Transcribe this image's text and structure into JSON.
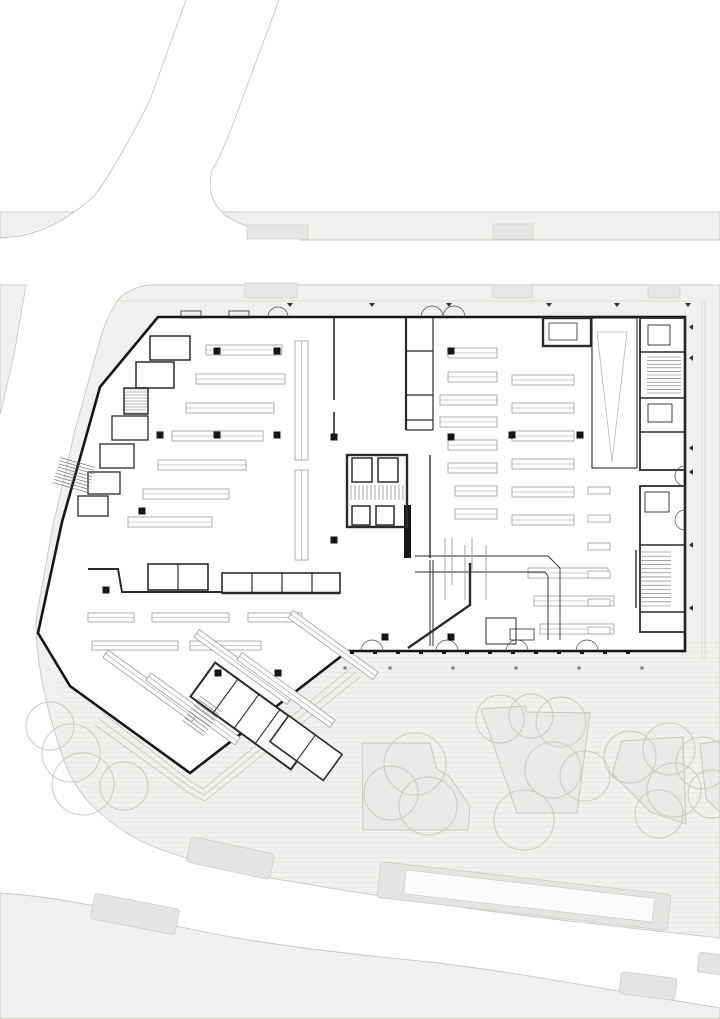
{
  "title": "site-floor-plan",
  "colors": {
    "background": "#ffffff",
    "pavement": "#f1f0ee",
    "pavement_edge": "#c9c6c2",
    "median": "#e6e4e2",
    "median_edge": "#cfccc8",
    "median_inset": "#fbfbfa",
    "canopy": "#e7e6e4",
    "planter": "#eae9e7",
    "planter_edge": "#c9c6c2",
    "tree": "#ccc9c5",
    "hatch": "#e3e1dd",
    "wall": "#161616",
    "wall_medium": "#2b2b2b",
    "shelf": "#9c9c9c",
    "faint": "#b9b6b2",
    "terrace": "#c6c3bf",
    "pipe": "#8f8f8f",
    "tick": "#333333"
  },
  "site": {
    "band_top": [
      0,
      212,
      720,
      28
    ],
    "region_main": "M150,285 L720,285 L720,938 C630,928 520,916 460,907 C420,901 370,895 330,888 C285,880 245,875 220,868 C185,858 155,849 135,838 C100,817 75,795 62,755 C48,713 36,668 36,620 L52,530 L75,430 L100,340 C104,325 110,312 118,300 C126,291 138,286 150,285 Z",
    "corner_bottom_left": "M0,893 C60,897 120,910 160,922 C240,942 330,952 430,962 C530,974 620,992 720,1008 L720,1019 L0,1019 Z",
    "sliver_left": "0,285 26,285 14,355 0,415",
    "road_diag_fill": "M186,0 L279,0 L240,105 Q220,160 212,170 Q205,198 225,215 Q245,230 300,238 L300,241 L0,241 L0,238 Q60,230 95,195 Q125,160 150,100 Z",
    "road_edges": [
      "M186,0 L150,100 Q120,160 95,195 Q60,228 20,236 L0,238",
      "M279,0 L240,105 Q220,160 212,170 Q205,198 225,215 Q245,230 300,238"
    ],
    "hatch_zone": [
      60,
      640,
      660,
      300
    ],
    "medians": [
      [
        188,
        845,
        85,
        26,
        12
      ],
      [
        92,
        901,
        86,
        26,
        11
      ],
      [
        378,
        878,
        292,
        36,
        6.5
      ],
      [
        620,
        975,
        56,
        22,
        7
      ],
      [
        698,
        954,
        34,
        20,
        7
      ]
    ],
    "median_inset": [
      404,
      884,
      250,
      24,
      6.5
    ],
    "canopies": [
      [
        247,
        225,
        61,
        14
      ],
      [
        493,
        224,
        40,
        15
      ],
      [
        245,
        283,
        52,
        15
      ],
      [
        493,
        285,
        39,
        13
      ],
      [
        648,
        285,
        32,
        13
      ]
    ],
    "planters": [
      "362,743 430,743 437,769 449,776 470,806 468,830 363,830",
      "481,709 526,706 526,712 590,713 577,813 517,813",
      "622,741 683,737 686,824 650,812 636,797 612,774",
      "700,744 720,741 720,812 706,799"
    ],
    "trees": [
      [
        50,
        726,
        24
      ],
      [
        71,
        753,
        29
      ],
      [
        83,
        784,
        31
      ],
      [
        124,
        786,
        24
      ],
      [
        415,
        764,
        31
      ],
      [
        391,
        793,
        27
      ],
      [
        428,
        806,
        29
      ],
      [
        500,
        719,
        24
      ],
      [
        531,
        716,
        22
      ],
      [
        561,
        722,
        25
      ],
      [
        553,
        770,
        28
      ],
      [
        585,
        776,
        25
      ],
      [
        524,
        820,
        30
      ],
      [
        630,
        757,
        26
      ],
      [
        669,
        749,
        26
      ],
      [
        674,
        790,
        27
      ],
      [
        659,
        814,
        24
      ],
      [
        702,
        763,
        26
      ],
      [
        712,
        794,
        24
      ]
    ],
    "faint_lines": [
      "M702,300 L702,660",
      "M705,300 L705,660",
      "M120,301 L690,301"
    ]
  },
  "building": {
    "outline": "M158,317 L685,317 L685,651 L348,651 L190,773 L70,686 L38,633 L62,522 L100,387 Z",
    "terrace_lines": [
      "M103,713 L190,781 L203,789 L352,667",
      "M99,719 L190,787 L204,795 L356,672",
      "M95,725 L189,793 L205,801 L360,677"
    ],
    "walls": [
      [
        "M334,317 L334,400",
        1.6
      ],
      [
        "M334,412 L334,437",
        1.6
      ],
      [
        "M406,318 L406,430",
        2.2
      ],
      [
        "M433,318 L433,430",
        1.2
      ],
      [
        "M406,351 L433,351",
        1.2
      ],
      [
        "M406,395 L433,395",
        1.2
      ],
      [
        "M406,420 L433,420",
        1.2
      ],
      [
        "M406,430 L433,430",
        1.2
      ],
      [
        "M430,455 L430,558",
        1.4
      ],
      [
        "M430,560 L430,646",
        1.0
      ],
      [
        "M433,560 L433,646",
        1.0
      ],
      [
        "M470,563 L470,605 L408,648",
        2.4
      ],
      [
        "M88,569 L118,569 L122,592 L222,592",
        2.0
      ],
      [
        "M222,593 L340,593",
        2.4
      ],
      [
        "M640,352 L685,352",
        1.4
      ],
      [
        "M640,398 L685,398",
        1.4
      ],
      [
        "M640,432 L685,432",
        1.4
      ],
      [
        "M640,545 L685,545",
        1.4
      ],
      [
        "M640,612 L685,612",
        1.4
      ],
      [
        "M252,573 L252,593",
        1.2
      ],
      [
        "M282,573 L282,593",
        1.2
      ],
      [
        "M312,573 L312,593",
        1.2
      ],
      [
        "M178,564 L178,590",
        1.2
      ],
      [
        "M636,550 L636,608",
        1.4
      ],
      [
        "M415,556 L548,556 L560,568 L560,640",
        0.9
      ],
      [
        "M415,572 L545,572 L548,576 L548,640",
        0.9
      ]
    ],
    "solid_blocks": [
      [
        404,
        505,
        7,
        53
      ]
    ],
    "rects": [
      [
        543,
        318,
        48,
        28,
        2.4
      ],
      [
        549,
        323,
        28,
        17,
        0.8
      ],
      [
        592,
        318,
        45,
        150,
        1.1
      ],
      [
        640,
        318,
        45,
        152,
        1.8
      ],
      [
        648,
        325,
        22,
        20,
        0.9
      ],
      [
        648,
        404,
        24,
        18,
        0.9
      ],
      [
        640,
        486,
        45,
        146,
        1.8
      ],
      [
        645,
        492,
        24,
        20,
        0.9
      ],
      [
        347,
        455,
        60,
        72,
        2.4
      ],
      [
        352,
        458,
        20,
        24,
        1.5
      ],
      [
        378,
        458,
        20,
        24,
        1.5
      ],
      [
        352,
        506,
        18,
        19,
        1.5
      ],
      [
        376,
        506,
        18,
        19,
        1.5
      ],
      [
        222,
        573,
        118,
        20,
        1.6
      ],
      [
        148,
        564,
        60,
        26,
        1.6
      ],
      [
        486,
        618,
        30,
        26,
        1.0
      ],
      [
        510,
        629,
        24,
        11,
        0.8
      ],
      [
        181,
        311,
        20,
        7,
        0.8
      ],
      [
        229,
        311,
        20,
        7,
        0.8
      ],
      [
        150,
        336,
        40,
        24,
        1.5
      ],
      [
        136,
        362,
        38,
        26,
        1.5
      ],
      [
        124,
        388,
        24,
        26,
        1.5
      ],
      [
        112,
        416,
        36,
        24,
        1.3
      ],
      [
        100,
        444,
        34,
        24,
        1.3
      ],
      [
        88,
        472,
        32,
        22,
        1.3
      ],
      [
        78,
        496,
        30,
        20,
        1.3
      ]
    ],
    "rot_blocks": [
      {
        "cx": 253,
        "cy": 716,
        "w": 124,
        "h": 42,
        "a": 36,
        "sw": 2.0,
        "dividers": [
          -34,
          -8,
          18
        ]
      },
      {
        "cx": 306,
        "cy": 748,
        "w": 66,
        "h": 32,
        "a": 36,
        "sw": 1.6,
        "dividers": [
          0
        ]
      }
    ],
    "stairs": [
      [
        125,
        389,
        22,
        24,
        0,
        8,
        "h"
      ],
      [
        351,
        485,
        52,
        15,
        0,
        13,
        "v"
      ],
      [
        647,
        357,
        34,
        36,
        0,
        10,
        "h"
      ],
      [
        639,
        552,
        32,
        54,
        0,
        13,
        "h"
      ],
      [
        189,
        701,
        26,
        30,
        36,
        8,
        "h"
      ],
      [
        56,
        462,
        36,
        26,
        16,
        8,
        "h"
      ]
    ],
    "triangle": "597,332 627,332 612,462",
    "shelves_h": [
      [
        206,
        345,
        76,
        10
      ],
      [
        196,
        374,
        89,
        10
      ],
      [
        186,
        403,
        88,
        10
      ],
      [
        172,
        431,
        91,
        10
      ],
      [
        158,
        460,
        88,
        10
      ],
      [
        143,
        489,
        86,
        10
      ],
      [
        128,
        517,
        84,
        10
      ],
      [
        295,
        341,
        13,
        119
      ],
      [
        295,
        470,
        13,
        90
      ],
      [
        448,
        348,
        49,
        10
      ],
      [
        448,
        372,
        49,
        10
      ],
      [
        440,
        395,
        57,
        10
      ],
      [
        440,
        417,
        57,
        10
      ],
      [
        448,
        440,
        49,
        10
      ],
      [
        448,
        463,
        49,
        10
      ],
      [
        455,
        486,
        42,
        10
      ],
      [
        455,
        509,
        42,
        10
      ],
      [
        512,
        375,
        62,
        10
      ],
      [
        512,
        403,
        62,
        10
      ],
      [
        512,
        431,
        62,
        10
      ],
      [
        512,
        459,
        62,
        10
      ],
      [
        512,
        487,
        62,
        10
      ],
      [
        512,
        515,
        62,
        10
      ],
      [
        528,
        568,
        80,
        10
      ],
      [
        534,
        596,
        80,
        10
      ],
      [
        540,
        624,
        74,
        10
      ],
      [
        588,
        487,
        22,
        7
      ],
      [
        588,
        515,
        22,
        7
      ],
      [
        588,
        543,
        22,
        7
      ],
      [
        588,
        571,
        22,
        7
      ],
      [
        588,
        599,
        22,
        7
      ],
      [
        588,
        627,
        22,
        7
      ],
      [
        88,
        613,
        46,
        9
      ],
      [
        152,
        613,
        77,
        9
      ],
      [
        248,
        613,
        54,
        9
      ],
      [
        92,
        641,
        86,
        9
      ],
      [
        190,
        641,
        71,
        9
      ]
    ],
    "shelves_angled": [
      [
        150,
        686,
        110,
        9,
        36
      ],
      [
        193,
        709,
        110,
        9,
        36
      ],
      [
        243,
        667,
        115,
        9,
        36
      ],
      [
        286,
        690,
        115,
        9,
        36
      ],
      [
        333,
        645,
        105,
        9,
        36
      ]
    ],
    "columns": [
      [
        217,
        351
      ],
      [
        277,
        351
      ],
      [
        451,
        351
      ],
      [
        160,
        435
      ],
      [
        217,
        435
      ],
      [
        277,
        435
      ],
      [
        334,
        437
      ],
      [
        451,
        437
      ],
      [
        512,
        435
      ],
      [
        580,
        435
      ],
      [
        334,
        540
      ],
      [
        142,
        511
      ],
      [
        106,
        590
      ],
      [
        385,
        637
      ],
      [
        451,
        637
      ],
      [
        218,
        673
      ],
      [
        278,
        673
      ]
    ],
    "facade_posts_y": 652,
    "facade_posts_x": [
      352,
      375,
      398,
      421,
      444,
      467,
      490,
      513,
      536,
      559,
      582,
      605,
      628
    ],
    "plaza_dots": [
      [
        345,
        668
      ],
      [
        390,
        668
      ],
      [
        453,
        668
      ],
      [
        516,
        668
      ],
      [
        579,
        668
      ],
      [
        642,
        668
      ]
    ],
    "ticks_north": [
      [
        290,
        303
      ],
      [
        372,
        303
      ],
      [
        449,
        303
      ],
      [
        549,
        303
      ],
      [
        617,
        303
      ],
      [
        688,
        303
      ]
    ],
    "ticks_east": [
      [
        693,
        327
      ],
      [
        693,
        358
      ],
      [
        693,
        448
      ],
      [
        693,
        472
      ],
      [
        693,
        545
      ],
      [
        693,
        608
      ]
    ],
    "door_arcs": [
      "M421,317 a11,11 0 0 1 22,0",
      "M443,317 a11,11 0 0 1 22,0",
      "M268,317 a10,10 0 0 1 20,0",
      "M361,651 a11,11 0 0 1 22,0",
      "M436,651 a11,11 0 0 1 22,0",
      "M506,651 a11,11 0 0 1 22,0",
      "M576,651 a11,11 0 0 1 22,0",
      "M685,466 a10,10 0 0 0 0,20",
      "M685,510 a10,10 0 0 0 0,20"
    ],
    "pipes": [
      "M445,538 L445,600",
      "M452,538 L452,585",
      "M465,545 L465,600",
      "M472,538 L472,570",
      "M486,545 L486,600"
    ]
  }
}
